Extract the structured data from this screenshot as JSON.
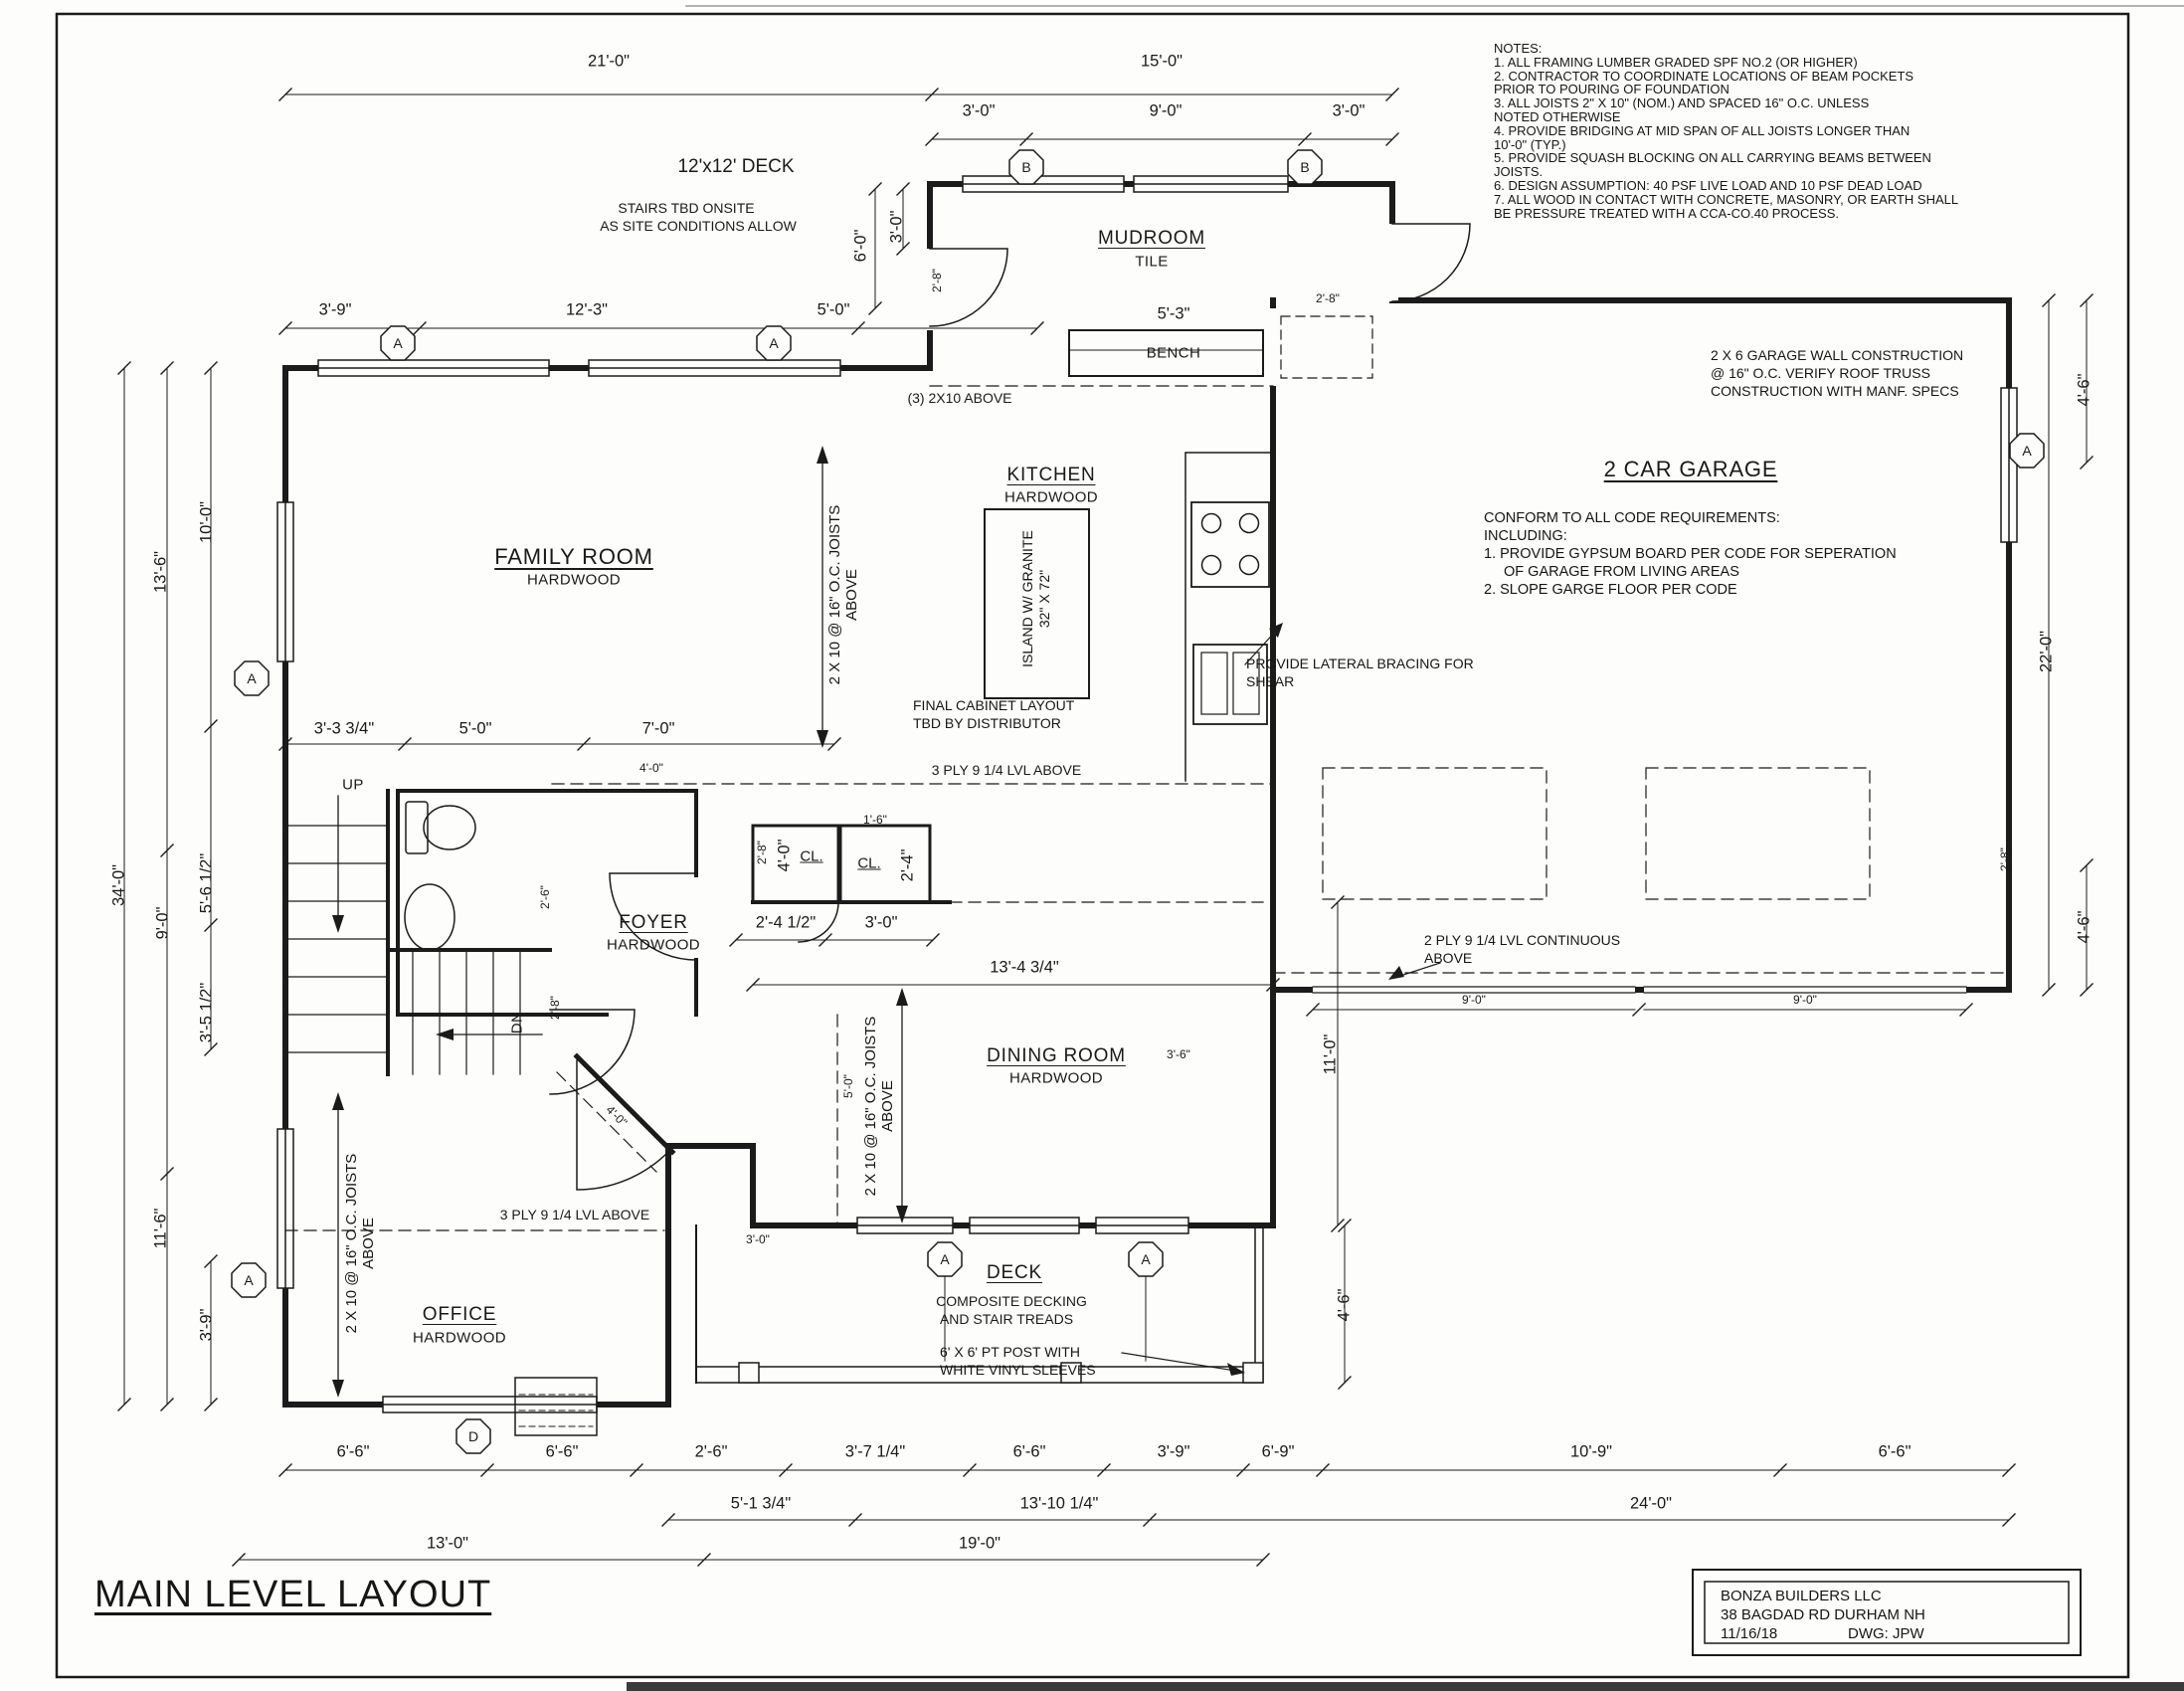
{
  "title": "MAIN LEVEL LAYOUT",
  "title_block": {
    "company": "BONZA BUILDERS LLC",
    "address": "38 BAGDAD RD DURHAM NH",
    "date": "11/16/18",
    "dwg": "DWG:  JPW"
  },
  "notes": {
    "heading": "NOTES:",
    "lines": [
      "1. ALL FRAMING LUMBER GRADED SPF NO.2 (OR HIGHER)",
      "2. CONTRACTOR TO COORDINATE LOCATIONS OF BEAM POCKETS",
      "PRIOR TO POURING OF FOUNDATION",
      "3. ALL JOISTS 2\" X 10\" (NOM.) AND SPACED 16\" O.C. UNLESS",
      "NOTED OTHERWISE",
      "4. PROVIDE BRIDGING AT MID SPAN OF ALL JOISTS LONGER THAN",
      "10'-0\" (TYP.)",
      "5. PROVIDE SQUASH BLOCKING ON ALL CARRYING BEAMS BETWEEN",
      "JOISTS.",
      "6. DESIGN ASSUMPTION:  40 PSF LIVE LOAD AND 10 PSF DEAD LOAD",
      "7. ALL WOOD IN CONTACT WITH CONCRETE, MASONRY, OR EARTH SHALL",
      "BE PRESSURE TREATED WITH A CCA-CO.40 PROCESS."
    ]
  },
  "rooms": {
    "deck_top": {
      "label": "12'x12' DECK",
      "n1": "STAIRS TBD ONSITE",
      "n2": "AS SITE CONDITIONS ALLOW"
    },
    "mudroom": {
      "label": "MUDROOM",
      "floor": "TILE"
    },
    "kitchen": {
      "label": "KITCHEN",
      "floor": "HARDWOOD"
    },
    "family": {
      "label": "FAMILY ROOM",
      "floor": "HARDWOOD"
    },
    "garage": {
      "label": "2 CAR GARAGE",
      "n1": "CONFORM TO ALL CODE REQUIREMENTS:",
      "n2": "INCLUDING:",
      "n3": "1. PROVIDE GYPSUM BOARD PER CODE FOR SEPERATION",
      "n4": "OF GARAGE FROM LIVING AREAS",
      "n5": "2. SLOPE GARGE FLOOR PER CODE"
    },
    "foyer": {
      "label": "FOYER",
      "floor": "HARDWOOD"
    },
    "dining": {
      "label": "DINING ROOM",
      "floor": "HARDWOOD"
    },
    "office": {
      "label": "OFFICE",
      "floor": "HARDWOOD"
    },
    "deck": {
      "label": "DECK",
      "n1": "COMPOSITE DECKING",
      "n2": "AND STAIR TREADS",
      "n3": "6' X 6' PT POST WITH",
      "n4": "WHITE VINYL SLEEVES"
    },
    "bench": "BENCH",
    "cl1": "CL.",
    "cl2": "CL.",
    "up": "UP",
    "dn": "DN"
  },
  "ann": {
    "three": "(3) 2X10  ABOVE",
    "joists1": "2 X 10 @ 16\" O.C. JOISTS",
    "joists2": "ABOVE",
    "lvl3": "3 PLY 9 1/4 LVL ABOVE",
    "lvl2a": "2 PLY 9 1/4 LVL CONTINUOUS",
    "lvl2b": "ABOVE",
    "lat1": "PROVIDE LATERAL BRACING FOR",
    "lat2": "SHEAR",
    "island1": "ISLAND W/ GRANITE",
    "island2": "32\" X 72\"",
    "cab1": "FINAL CABINET LAYOUT",
    "cab2": "TBD BY DISTRIBUTOR",
    "gw1": "2 X 6 GARAGE WALL CONSTRUCTION",
    "gw2": "@ 16\" O.C. VERIFY ROOF TRUSS",
    "gw3": "CONSTRUCTION WITH MANF. SPECS"
  },
  "dims": {
    "t21": "21'-0\"",
    "t15": "15'-0\"",
    "t3a": "3'-0\"",
    "t9": "9'-0\"",
    "t3b": "3'-0\"",
    "s39": "3'-9\"",
    "s123": "12'-3\"",
    "s50": "5'-0\"",
    "v60": "6'-0\"",
    "v30": "3'-0\"",
    "v28": "2'-8\"",
    "b53": "5'-3\"",
    "mg28": "2'-8\"",
    "L340": "34'-0\"",
    "L136": "13'-6\"",
    "L90": "9'-0\"",
    "L100": "10'-0\"",
    "L56": "5'-6 1/2\"",
    "L35": "3'-5 1/2\"",
    "L116": "11'-6\"",
    "L39": "3'-9\"",
    "f33": "3'-3 3/4\"",
    "f50": "5'-0\"",
    "f70": "7'-0\"",
    "f40": "4'-0\"",
    "c28": "2'-8\"",
    "c40": "4'-0\"",
    "c16": "1'-6\"",
    "c24": "2'-4\"",
    "ba26": "2'-6\"",
    "dn28": "2'-8\"",
    "fy24": "2'-4 1/2\"",
    "fy30": "3'-0\"",
    "fy13": "13'-4 3/4\"",
    "fy36": "3'-6\"",
    "di50": "5'-0\"",
    "di40": "4'-0\"",
    "di110": "11'-0\"",
    "di30": "3'-0\"",
    "de46": "4'-6\"",
    "g90a": "9'-0\"",
    "g90b": "9'-0\"",
    "r46a": "4'-6\"",
    "r220": "22'-0\"",
    "r28": "2'-8\"",
    "r46b": "4'-6\"",
    "bb66a": "6'-6\"",
    "bb66b": "6'-6\"",
    "bb26": "2'-6\"",
    "bb37": "3'-7 1/4\"",
    "bb66c": "6'-6\"",
    "bb39": "3'-9\"",
    "bb69": "6'-9\"",
    "bb109": "10'-9\"",
    "bb66d": "6'-6\"",
    "bb51": "5'-1 3/4\"",
    "bb1310": "13'-10 1/4\"",
    "bb24": "24'-0\"",
    "bb13": "13'-0\"",
    "bb19": "19'-0\""
  },
  "markers": {
    "a": "A",
    "b": "B",
    "d": "D"
  }
}
